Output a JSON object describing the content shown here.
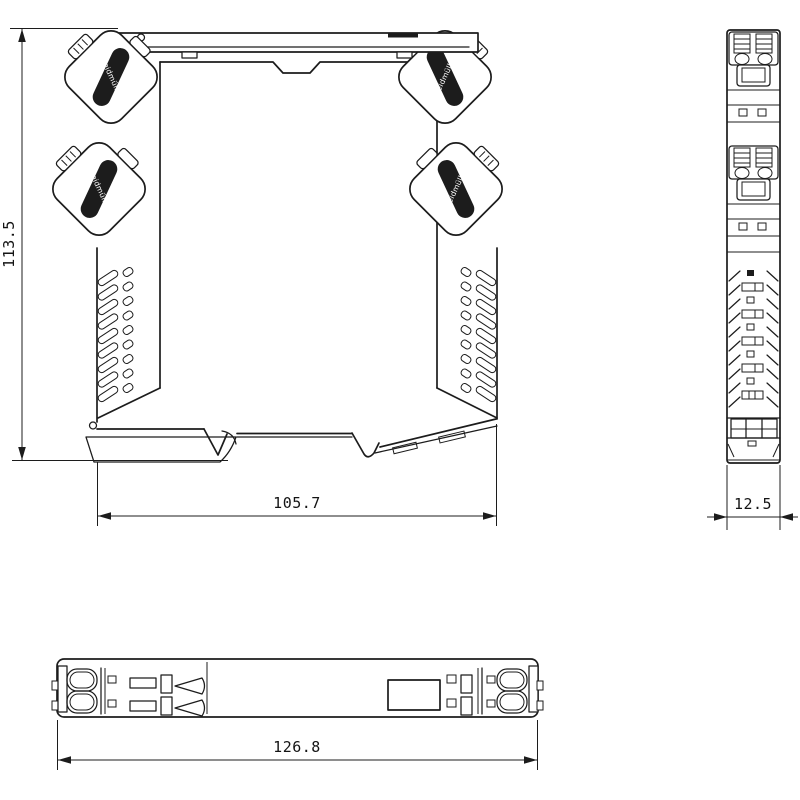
{
  "drawing": {
    "brand_label": "Weidmüller",
    "dimensions": {
      "front_height": "113.5",
      "front_width": "105.7",
      "side_width": "12.5",
      "bottom_length": "126.8"
    },
    "colors": {
      "line": "#1c1c1c",
      "background": "#ffffff"
    }
  }
}
